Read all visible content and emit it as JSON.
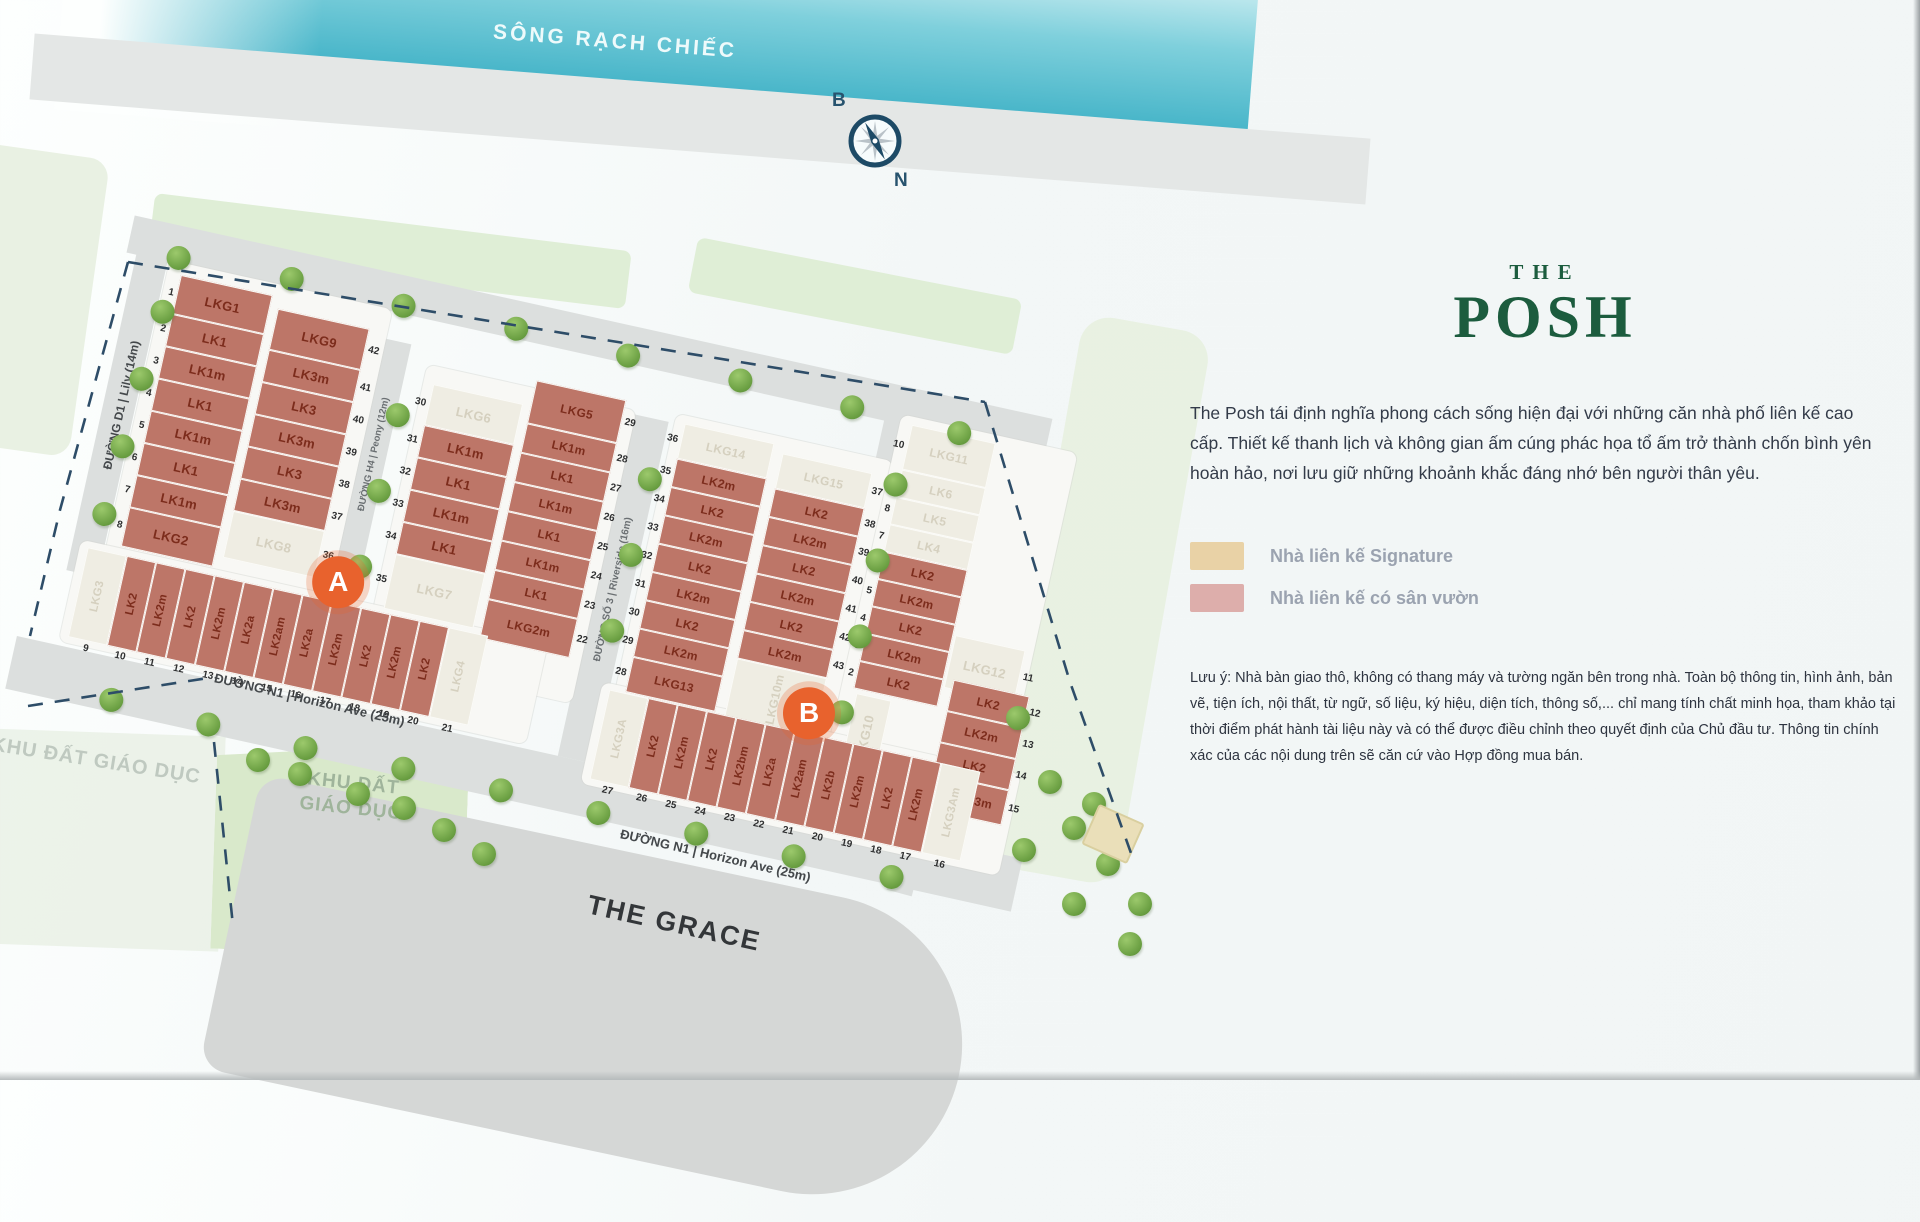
{
  "river": {
    "label": "SÔNG RẠCH CHIẾC"
  },
  "compass": {
    "top": "B",
    "bottom": "N"
  },
  "markers": {
    "a": "A",
    "b": "B"
  },
  "roads": {
    "lily": "ĐƯỜNG D1 | Lily (14m)",
    "peony": "ĐƯỜNG H4 | Peony (12m)",
    "riverside": "ĐƯỜNG SỐ 3 | Riverside (16m)",
    "mimosa": "ĐƯỜNG N5 | Mimosa (12m)",
    "orchid": "ĐƯỜNG D3 | Orchid (14m)",
    "horizon_a": "ĐƯỜNG N1 | Horizon Ave (25m)",
    "horizon_b": "ĐƯỜNG N1 | Horizon Ave (25m)"
  },
  "areas": {
    "education_left": "KHU ĐẤT GIÁO DỤC",
    "education_main": "KHU ĐẤT GIÁO DỤC",
    "grace": "THE GRACE"
  },
  "clusters": [
    {
      "id": "a1-left",
      "lots": [
        {
          "n": "1",
          "label": "LKG1",
          "t": "g"
        },
        {
          "n": "2",
          "label": "LK1",
          "t": "g"
        },
        {
          "n": "3",
          "label": "LK1m",
          "t": "g"
        },
        {
          "n": "4",
          "label": "LK1",
          "t": "g"
        },
        {
          "n": "5",
          "label": "LK1m",
          "t": "g"
        },
        {
          "n": "6",
          "label": "LK1",
          "t": "g"
        },
        {
          "n": "7",
          "label": "LK1m",
          "t": "g"
        },
        {
          "n": "8",
          "label": "LKG2",
          "t": "g"
        }
      ]
    },
    {
      "id": "a1-right",
      "lots": [
        {
          "n": "42",
          "label": "LKG9",
          "t": "g"
        },
        {
          "n": "41",
          "label": "LK3m",
          "t": "g"
        },
        {
          "n": "40",
          "label": "LK3",
          "t": "g"
        },
        {
          "n": "39",
          "label": "LK3m",
          "t": "g"
        },
        {
          "n": "38",
          "label": "LK3",
          "t": "g"
        },
        {
          "n": "37",
          "label": "LK3m",
          "t": "g"
        },
        {
          "n": "36",
          "label": "LKG8",
          "t": "s"
        }
      ]
    },
    {
      "id": "a2-left",
      "lots": [
        {
          "n": "30",
          "label": "LKG6",
          "t": "s"
        },
        {
          "n": "31",
          "label": "LK1m",
          "t": "g"
        },
        {
          "n": "32",
          "label": "LK1",
          "t": "g"
        },
        {
          "n": "33",
          "label": "LK1m",
          "t": "g"
        },
        {
          "n": "34",
          "label": "LK1",
          "t": "g"
        },
        {
          "n": "35",
          "label": "LKG7",
          "t": "s"
        }
      ]
    },
    {
      "id": "a2-right",
      "lots": [
        {
          "n": "29",
          "label": "LKG5",
          "t": "g"
        },
        {
          "n": "28",
          "label": "LK1m",
          "t": "g"
        },
        {
          "n": "27",
          "label": "LK1",
          "t": "g"
        },
        {
          "n": "26",
          "label": "LK1m",
          "t": "g"
        },
        {
          "n": "25",
          "label": "LK1",
          "t": "g"
        },
        {
          "n": "24",
          "label": "LK1m",
          "t": "g"
        },
        {
          "n": "23",
          "label": "LK1",
          "t": "g"
        },
        {
          "n": "22",
          "label": "LKG2m",
          "t": "g"
        }
      ]
    },
    {
      "id": "a-row",
      "lots": [
        {
          "n": "9",
          "label": "LKG3",
          "t": "s"
        },
        {
          "n": "10",
          "label": "LK2",
          "t": "g"
        },
        {
          "n": "11",
          "label": "LK2m",
          "t": "g"
        },
        {
          "n": "12",
          "label": "LK2",
          "t": "g"
        },
        {
          "n": "13",
          "label": "LK2m",
          "t": "g"
        },
        {
          "n": "14",
          "label": "LK2a",
          "t": "g"
        },
        {
          "n": "15",
          "label": "LK2am",
          "t": "g"
        },
        {
          "n": "16",
          "label": "LK2a",
          "t": "g"
        },
        {
          "n": "17",
          "label": "LK2m",
          "t": "g"
        },
        {
          "n": "18",
          "label": "LK2",
          "t": "g"
        },
        {
          "n": "19",
          "label": "LK2m",
          "t": "g"
        },
        {
          "n": "20",
          "label": "LK2",
          "t": "g"
        },
        {
          "n": "21",
          "label": "LKG4",
          "t": "s"
        }
      ]
    },
    {
      "id": "b1-left",
      "lots": [
        {
          "n": "36",
          "label": "LKG14",
          "t": "s"
        },
        {
          "n": "35",
          "label": "LK2m",
          "t": "g"
        },
        {
          "n": "34",
          "label": "LK2",
          "t": "g"
        },
        {
          "n": "33",
          "label": "LK2m",
          "t": "g"
        },
        {
          "n": "32",
          "label": "LK2",
          "t": "g"
        },
        {
          "n": "31",
          "label": "LK2m",
          "t": "g"
        },
        {
          "n": "30",
          "label": "LK2",
          "t": "g"
        },
        {
          "n": "29",
          "label": "LK2m",
          "t": "g"
        },
        {
          "n": "28",
          "label": "LKG13",
          "t": "g"
        }
      ]
    },
    {
      "id": "b1-right",
      "lots": [
        {
          "n": "37",
          "label": "LKG15",
          "t": "s"
        },
        {
          "n": "38",
          "label": "LK2",
          "t": "g"
        },
        {
          "n": "39",
          "label": "LK2m",
          "t": "g"
        },
        {
          "n": "40",
          "label": "LK2",
          "t": "g"
        },
        {
          "n": "41",
          "label": "LK2m",
          "t": "g"
        },
        {
          "n": "42",
          "label": "LK2",
          "t": "g"
        },
        {
          "n": "43",
          "label": "LK2m",
          "t": "g"
        },
        {
          "n": "44",
          "label": "LKG10m",
          "t": "s"
        }
      ]
    },
    {
      "id": "b2-col",
      "lots": [
        {
          "n": "10",
          "label": "LKG11",
          "t": "s"
        },
        {
          "n": "9",
          "label": "LK6",
          "t": "s"
        },
        {
          "n": "8",
          "label": "LK5",
          "t": "s"
        },
        {
          "n": "7",
          "label": "LK4",
          "t": "s"
        },
        {
          "n": "6",
          "label": "LK2",
          "t": "g"
        },
        {
          "n": "5",
          "label": "LK2m",
          "t": "g"
        },
        {
          "n": "4",
          "label": "LK2",
          "t": "g"
        },
        {
          "n": "3",
          "label": "LK2m",
          "t": "g"
        },
        {
          "n": "2",
          "label": "LK2",
          "t": "g"
        }
      ]
    },
    {
      "id": "b2-lkg12",
      "lots": [
        {
          "n": "11",
          "label": "LKG12",
          "t": "s"
        }
      ]
    },
    {
      "id": "b2-low",
      "lots": [
        {
          "n": "12",
          "label": "LK2",
          "t": "g"
        },
        {
          "n": "13",
          "label": "LK2m",
          "t": "g"
        },
        {
          "n": "14",
          "label": "LK2",
          "t": "g"
        },
        {
          "n": "15",
          "label": "LKG13m",
          "t": "g"
        }
      ]
    },
    {
      "id": "b2-lkg10",
      "lots": [
        {
          "n": "1",
          "label": "LKG10",
          "t": "s"
        }
      ]
    },
    {
      "id": "b-row",
      "lots": [
        {
          "n": "27",
          "label": "LKG3A",
          "t": "s"
        },
        {
          "n": "26",
          "label": "LK2",
          "t": "g"
        },
        {
          "n": "25",
          "label": "LK2m",
          "t": "g"
        },
        {
          "n": "24",
          "label": "LK2",
          "t": "g"
        },
        {
          "n": "23",
          "label": "LK2bm",
          "t": "g"
        },
        {
          "n": "22",
          "label": "LK2a",
          "t": "g"
        },
        {
          "n": "21",
          "label": "LK2am",
          "t": "g"
        },
        {
          "n": "20",
          "label": "LK2b",
          "t": "g"
        },
        {
          "n": "19",
          "label": "LK2m",
          "t": "g"
        },
        {
          "n": "18",
          "label": "LK2",
          "t": "g"
        },
        {
          "n": "17",
          "label": "LK2m",
          "t": "g"
        },
        {
          "n": "16",
          "label": "LKG3Am",
          "t": "s"
        }
      ]
    }
  ],
  "trees": {
    "plan": [
      [
        100,
        84
      ],
      [
        215,
        80
      ],
      [
        330,
        82
      ],
      [
        445,
        80
      ],
      [
        560,
        82
      ],
      [
        675,
        82
      ],
      [
        790,
        84
      ],
      [
        900,
        86
      ],
      [
        96,
        140
      ],
      [
        90,
        210
      ],
      [
        86,
        280
      ],
      [
        83,
        350
      ],
      [
        348,
        190
      ],
      [
        346,
        268
      ],
      [
        344,
        346
      ],
      [
        608,
        198
      ],
      [
        606,
        276
      ],
      [
        604,
        354
      ],
      [
        849,
        150
      ],
      [
        848,
        228
      ],
      [
        847,
        306
      ],
      [
        846,
        384
      ],
      [
        130,
        530
      ],
      [
        230,
        533
      ],
      [
        330,
        535
      ],
      [
        430,
        534
      ],
      [
        530,
        534
      ],
      [
        630,
        535
      ],
      [
        730,
        534
      ],
      [
        830,
        535
      ],
      [
        930,
        534
      ]
    ],
    "page": [
      [
        1006,
        706
      ],
      [
        1038,
        770
      ],
      [
        1012,
        838
      ],
      [
        1062,
        816
      ],
      [
        1096,
        852
      ],
      [
        1128,
        892
      ],
      [
        1062,
        892
      ],
      [
        1082,
        792
      ],
      [
        1118,
        932
      ],
      [
        246,
        748
      ],
      [
        288,
        762
      ],
      [
        346,
        782
      ],
      [
        392,
        796
      ],
      [
        432,
        818
      ],
      [
        472,
        842
      ]
    ]
  },
  "panel": {
    "brand_the": "THE",
    "brand_posh": "POSH",
    "description": "The Posh tái định nghĩa phong cách sống hiện đại với những căn nhà phố liên kế cao cấp. Thiết kế thanh lịch và không gian ấm cúng phác họa tổ ấm trở thành chốn bình yên hoàn hảo, nơi lưu giữ những khoảnh khắc đáng nhớ bên người thân yêu.",
    "legend": [
      {
        "color": "#e9d2a6",
        "label": "Nhà liên kế Signature"
      },
      {
        "color": "#ddaeab",
        "label": "Nhà liên kế có sân vườn"
      }
    ],
    "note": "Lưu ý: Nhà bàn giao thô, không có thang máy và tường ngăn bên trong nhà. Toàn bộ thông tin, hình ảnh, bản vẽ, tiện ích, nội thất, từ ngữ, số liệu, ký hiệu, diện tích, thông số,... chỉ mang tính chất minh họa, tham khảo tại thời điểm phát hành tài liệu này và có thể được điều chỉnh theo quyết định của Chủ đầu tư. Thông tin chính xác của các nội dung trên sẽ căn cứ vào Hợp đồng mua bán."
  },
  "colors": {
    "garden_lot": "#bd7668",
    "signature_lot": "#efede3",
    "marker_orange": "#e8622d",
    "brand_green": "#1c5c3e",
    "river_teal": "#45b4c8"
  }
}
